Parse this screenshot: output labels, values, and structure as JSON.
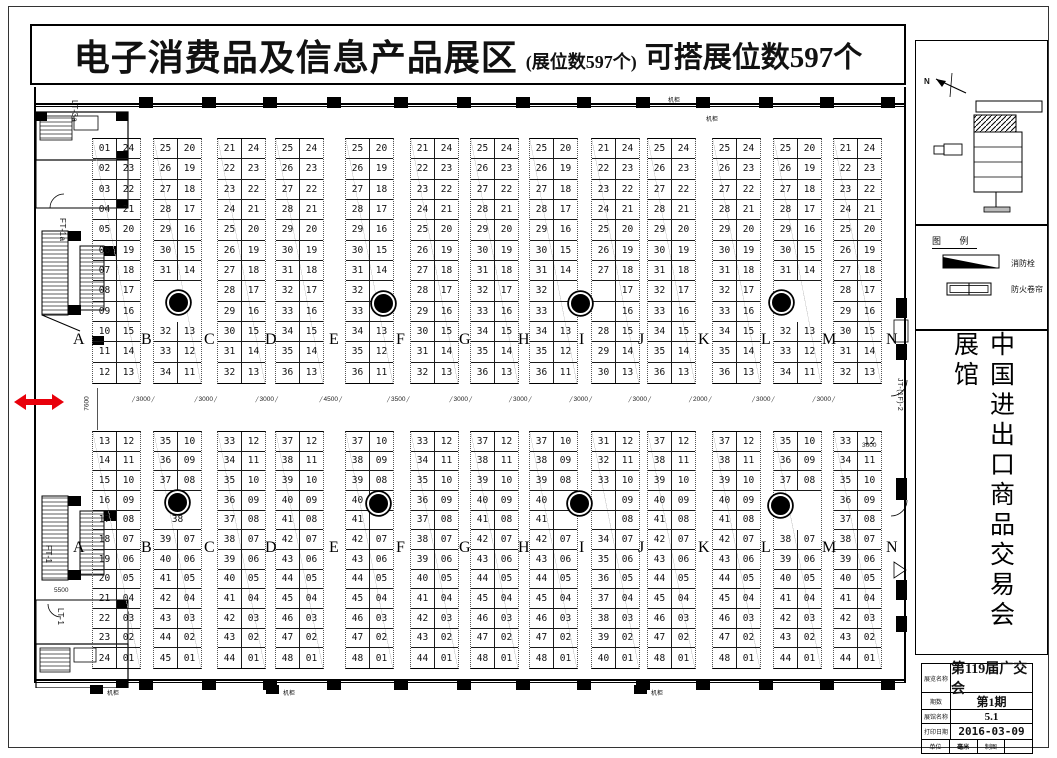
{
  "header": {
    "title": "电子消费品及信息产品展区",
    "booth_count_note": "(展位数597个)",
    "buildable_note": "可搭展位数597个"
  },
  "row_letters": [
    "A",
    "B",
    "C",
    "D",
    "E",
    "F",
    "G",
    "H",
    "I",
    "J",
    "K",
    "L",
    "M",
    "N"
  ],
  "aisle_dims": [
    "3000",
    "3000",
    "3000",
    "4500",
    "3500",
    "3000",
    "3000",
    "3000",
    "3000",
    "2000",
    "3000",
    "3000"
  ],
  "other_dims": {
    "aisle_height": "7600",
    "right_gate": "3600",
    "left_lower": "5500"
  },
  "edge_labels": {
    "lt3a": "LT-3a",
    "ft1a": "FT-1a",
    "ft1": "FT-1",
    "lt1": "LT-1",
    "jt": "JT-(1F)-2"
  },
  "labels": {
    "machine_cabinet": "机柜"
  },
  "compass_label": "N",
  "legend": {
    "title": "图 例",
    "items": [
      {
        "label": "消防栓"
      },
      {
        "label": "防火卷帘"
      }
    ]
  },
  "side_title": "中国进出口商品交易会展馆",
  "title_block": {
    "rows": [
      {
        "label": "展览名称",
        "value": "第119届广交会"
      },
      {
        "label": "期数",
        "value": "第1期"
      },
      {
        "label": "展馆名称",
        "value": "5.1"
      },
      {
        "label": "打印日期",
        "value": "2016-03-09"
      }
    ],
    "last_row": [
      "单位",
      "毫米",
      "制图",
      ""
    ]
  },
  "top_strips": [
    {
      "rows": [
        [
          "01",
          "24"
        ],
        [
          "02",
          "23"
        ],
        [
          "03",
          "22"
        ],
        [
          "04",
          "21"
        ],
        [
          "05",
          "20"
        ],
        [
          "06",
          "19"
        ],
        [
          "07",
          "18"
        ],
        [
          "08",
          "17"
        ],
        [
          "09",
          "16"
        ],
        [
          "10",
          "15"
        ],
        [
          "11",
          "14"
        ],
        [
          "12",
          "13"
        ]
      ]
    },
    {
      "rows": [
        [
          "25",
          "20"
        ],
        [
          "26",
          "19"
        ],
        [
          "27",
          "18"
        ],
        [
          "28",
          "17"
        ],
        [
          "29",
          "16"
        ],
        [
          "30",
          "15"
        ],
        [
          "31",
          "14"
        ],
        [
          "#GAP",
          "2"
        ],
        [
          "32",
          "13"
        ],
        [
          "33",
          "12"
        ],
        [
          "34",
          "11"
        ]
      ]
    },
    {
      "rows": [
        [
          "21",
          "24"
        ],
        [
          "22",
          "23"
        ],
        [
          "23",
          "22"
        ],
        [
          "24",
          "21"
        ],
        [
          "25",
          "20"
        ],
        [
          "26",
          "19"
        ],
        [
          "27",
          "18"
        ],
        [
          "28",
          "17"
        ],
        [
          "29",
          "16"
        ],
        [
          "30",
          "15"
        ],
        [
          "31",
          "14"
        ],
        [
          "32",
          "13"
        ]
      ]
    },
    {
      "rows": [
        [
          "25",
          "24"
        ],
        [
          "26",
          "23"
        ],
        [
          "27",
          "22"
        ],
        [
          "28",
          "21"
        ],
        [
          "29",
          "20"
        ],
        [
          "30",
          "19"
        ],
        [
          "31",
          "18"
        ],
        [
          "32",
          "17"
        ],
        [
          "33",
          "16"
        ],
        [
          "34",
          "15"
        ],
        [
          "35",
          "14"
        ],
        [
          "36",
          "13"
        ]
      ]
    },
    {
      "rows": [
        [
          "25",
          "20"
        ],
        [
          "26",
          "19"
        ],
        [
          "27",
          "18"
        ],
        [
          "28",
          "17"
        ],
        [
          "29",
          "16"
        ],
        [
          "30",
          "15"
        ],
        [
          "31",
          "14"
        ],
        [
          "32",
          ""
        ],
        [
          "33",
          ""
        ],
        [
          "34",
          "13"
        ],
        [
          "35",
          "12"
        ],
        [
          "36",
          "11"
        ]
      ]
    },
    {
      "rows": [
        [
          "21",
          "24"
        ],
        [
          "22",
          "23"
        ],
        [
          "23",
          "22"
        ],
        [
          "24",
          "21"
        ],
        [
          "25",
          "20"
        ],
        [
          "26",
          "19"
        ],
        [
          "27",
          "18"
        ],
        [
          "28",
          "17"
        ],
        [
          "29",
          "16"
        ],
        [
          "30",
          "15"
        ],
        [
          "31",
          "14"
        ],
        [
          "32",
          "13"
        ]
      ]
    },
    {
      "rows": [
        [
          "25",
          "24"
        ],
        [
          "26",
          "23"
        ],
        [
          "27",
          "22"
        ],
        [
          "28",
          "21"
        ],
        [
          "29",
          "20"
        ],
        [
          "30",
          "19"
        ],
        [
          "31",
          "18"
        ],
        [
          "32",
          "17"
        ],
        [
          "33",
          "16"
        ],
        [
          "34",
          "15"
        ],
        [
          "35",
          "14"
        ],
        [
          "36",
          "13"
        ]
      ]
    },
    {
      "rows": [
        [
          "25",
          "20"
        ],
        [
          "26",
          "19"
        ],
        [
          "27",
          "18"
        ],
        [
          "28",
          "17"
        ],
        [
          "29",
          "16"
        ],
        [
          "30",
          "15"
        ],
        [
          "31",
          "14"
        ],
        [
          "32",
          ""
        ],
        [
          "33",
          ""
        ],
        [
          "34",
          "13"
        ],
        [
          "35",
          "12"
        ],
        [
          "36",
          "11"
        ]
      ]
    },
    {
      "rows": [
        [
          "21",
          "24"
        ],
        [
          "22",
          "23"
        ],
        [
          "23",
          "22"
        ],
        [
          "24",
          "21"
        ],
        [
          "25",
          "20"
        ],
        [
          "26",
          "19"
        ],
        [
          "27",
          "18"
        ],
        [
          "",
          "17"
        ],
        [
          "",
          "16"
        ],
        [
          "28",
          "15"
        ],
        [
          "29",
          "14"
        ],
        [
          "30",
          "13"
        ]
      ]
    },
    {
      "rows": [
        [
          "25",
          "24"
        ],
        [
          "26",
          "23"
        ],
        [
          "27",
          "22"
        ],
        [
          "28",
          "21"
        ],
        [
          "29",
          "20"
        ],
        [
          "30",
          "19"
        ],
        [
          "31",
          "18"
        ],
        [
          "32",
          "17"
        ],
        [
          "33",
          "16"
        ],
        [
          "34",
          "15"
        ],
        [
          "35",
          "14"
        ],
        [
          "36",
          "13"
        ]
      ]
    },
    {
      "rows": [
        [
          "25",
          "24"
        ],
        [
          "26",
          "23"
        ],
        [
          "27",
          "22"
        ],
        [
          "28",
          "21"
        ],
        [
          "29",
          "20"
        ],
        [
          "30",
          "19"
        ],
        [
          "31",
          "18"
        ],
        [
          "32",
          "17"
        ],
        [
          "33",
          "16"
        ],
        [
          "34",
          "15"
        ],
        [
          "35",
          "14"
        ],
        [
          "36",
          "13"
        ]
      ]
    },
    {
      "rows": [
        [
          "25",
          "20"
        ],
        [
          "26",
          "19"
        ],
        [
          "27",
          "18"
        ],
        [
          "28",
          "17"
        ],
        [
          "29",
          "16"
        ],
        [
          "30",
          "15"
        ],
        [
          "31",
          "14"
        ],
        [
          "#GAP",
          "2"
        ],
        [
          "32",
          "13"
        ],
        [
          "33",
          "12"
        ],
        [
          "34",
          "11"
        ]
      ]
    },
    {
      "rows": [
        [
          "21",
          "24"
        ],
        [
          "22",
          "23"
        ],
        [
          "23",
          "22"
        ],
        [
          "24",
          "21"
        ],
        [
          "25",
          "20"
        ],
        [
          "26",
          "19"
        ],
        [
          "27",
          "18"
        ],
        [
          "28",
          "17"
        ],
        [
          "29",
          "16"
        ],
        [
          "30",
          "15"
        ],
        [
          "31",
          "14"
        ],
        [
          "32",
          "13"
        ]
      ]
    }
  ],
  "bottom_strips": [
    {
      "rows": [
        [
          "13",
          "12"
        ],
        [
          "14",
          "11"
        ],
        [
          "15",
          "10"
        ],
        [
          "16",
          "09"
        ],
        [
          "17",
          "08"
        ],
        [
          "18",
          "07"
        ],
        [
          "19",
          "06"
        ],
        [
          "20",
          "05"
        ],
        [
          "21",
          "04"
        ],
        [
          "22",
          "03"
        ],
        [
          "23",
          "02"
        ],
        [
          "24",
          "01"
        ]
      ]
    },
    {
      "rows": [
        [
          "35",
          "10"
        ],
        [
          "36",
          "09"
        ],
        [
          "37",
          "08"
        ],
        [
          "#GAP",
          "1"
        ],
        [
          "38"
        ],
        [
          "39",
          "07"
        ],
        [
          "40",
          "06"
        ],
        [
          "41",
          "05"
        ],
        [
          "42",
          "04"
        ],
        [
          "43",
          "03"
        ],
        [
          "44",
          "02"
        ],
        [
          "45",
          "01"
        ]
      ]
    },
    {
      "rows": [
        [
          "33",
          "12"
        ],
        [
          "34",
          "11"
        ],
        [
          "35",
          "10"
        ],
        [
          "36",
          "09"
        ],
        [
          "37",
          "08"
        ],
        [
          "38",
          "07"
        ],
        [
          "39",
          "06"
        ],
        [
          "40",
          "05"
        ],
        [
          "41",
          "04"
        ],
        [
          "42",
          "03"
        ],
        [
          "43",
          "02"
        ],
        [
          "44",
          "01"
        ]
      ]
    },
    {
      "rows": [
        [
          "37",
          "12"
        ],
        [
          "38",
          "11"
        ],
        [
          "39",
          "10"
        ],
        [
          "40",
          "09"
        ],
        [
          "41",
          "08"
        ],
        [
          "42",
          "07"
        ],
        [
          "43",
          "06"
        ],
        [
          "44",
          "05"
        ],
        [
          "45",
          "04"
        ],
        [
          "46",
          "03"
        ],
        [
          "47",
          "02"
        ],
        [
          "48",
          "01"
        ]
      ]
    },
    {
      "rows": [
        [
          "37",
          "10"
        ],
        [
          "38",
          "09"
        ],
        [
          "39",
          "08"
        ],
        [
          "40",
          ""
        ],
        [
          "41",
          ""
        ],
        [
          "42",
          "07"
        ],
        [
          "43",
          "06"
        ],
        [
          "44",
          "05"
        ],
        [
          "45",
          "04"
        ],
        [
          "46",
          "03"
        ],
        [
          "47",
          "02"
        ],
        [
          "48",
          "01"
        ]
      ]
    },
    {
      "rows": [
        [
          "33",
          "12"
        ],
        [
          "34",
          "11"
        ],
        [
          "35",
          "10"
        ],
        [
          "36",
          "09"
        ],
        [
          "37",
          "08"
        ],
        [
          "38",
          "07"
        ],
        [
          "39",
          "06"
        ],
        [
          "40",
          "05"
        ],
        [
          "41",
          "04"
        ],
        [
          "42",
          "03"
        ],
        [
          "43",
          "02"
        ],
        [
          "44",
          "01"
        ]
      ]
    },
    {
      "rows": [
        [
          "37",
          "12"
        ],
        [
          "38",
          "11"
        ],
        [
          "39",
          "10"
        ],
        [
          "40",
          "09"
        ],
        [
          "41",
          "08"
        ],
        [
          "42",
          "07"
        ],
        [
          "43",
          "06"
        ],
        [
          "44",
          "05"
        ],
        [
          "45",
          "04"
        ],
        [
          "46",
          "03"
        ],
        [
          "47",
          "02"
        ],
        [
          "48",
          "01"
        ]
      ]
    },
    {
      "rows": [
        [
          "37",
          "10"
        ],
        [
          "38",
          "09"
        ],
        [
          "39",
          "08"
        ],
        [
          "40",
          ""
        ],
        [
          "41",
          ""
        ],
        [
          "42",
          "07"
        ],
        [
          "43",
          "06"
        ],
        [
          "44",
          "05"
        ],
        [
          "45",
          "04"
        ],
        [
          "46",
          "03"
        ],
        [
          "47",
          "02"
        ],
        [
          "48",
          "01"
        ]
      ]
    },
    {
      "rows": [
        [
          "31",
          "12"
        ],
        [
          "32",
          "11"
        ],
        [
          "33",
          "10"
        ],
        [
          "",
          "09"
        ],
        [
          "",
          "08"
        ],
        [
          "34",
          "07"
        ],
        [
          "35",
          "06"
        ],
        [
          "36",
          "05"
        ],
        [
          "37",
          "04"
        ],
        [
          "38",
          "03"
        ],
        [
          "39",
          "02"
        ],
        [
          "40",
          "01"
        ]
      ]
    },
    {
      "rows": [
        [
          "37",
          "12"
        ],
        [
          "38",
          "11"
        ],
        [
          "39",
          "10"
        ],
        [
          "40",
          "09"
        ],
        [
          "41",
          "08"
        ],
        [
          "42",
          "07"
        ],
        [
          "43",
          "06"
        ],
        [
          "44",
          "05"
        ],
        [
          "45",
          "04"
        ],
        [
          "46",
          "03"
        ],
        [
          "47",
          "02"
        ],
        [
          "48",
          "01"
        ]
      ]
    },
    {
      "rows": [
        [
          "37",
          "12"
        ],
        [
          "38",
          "11"
        ],
        [
          "39",
          "10"
        ],
        [
          "40",
          "09"
        ],
        [
          "41",
          "08"
        ],
        [
          "42",
          "07"
        ],
        [
          "43",
          "06"
        ],
        [
          "44",
          "05"
        ],
        [
          "45",
          "04"
        ],
        [
          "46",
          "03"
        ],
        [
          "47",
          "02"
        ],
        [
          "48",
          "01"
        ]
      ]
    },
    {
      "rows": [
        [
          "35",
          "10"
        ],
        [
          "36",
          "09"
        ],
        [
          "37",
          "08"
        ],
        [
          "#GAP",
          "2"
        ],
        [
          "38",
          "07"
        ],
        [
          "39",
          "06"
        ],
        [
          "40",
          "05"
        ],
        [
          "41",
          "04"
        ],
        [
          "42",
          "03"
        ],
        [
          "43",
          "02"
        ],
        [
          "44",
          "01"
        ]
      ]
    },
    {
      "rows": [
        [
          "33",
          "12"
        ],
        [
          "34",
          "11"
        ],
        [
          "35",
          "10"
        ],
        [
          "36",
          "09"
        ],
        [
          "37",
          "08"
        ],
        [
          "38",
          "07"
        ],
        [
          "39",
          "06"
        ],
        [
          "40",
          "05"
        ],
        [
          "41",
          "04"
        ],
        [
          "42",
          "03"
        ],
        [
          "43",
          "02"
        ],
        [
          "44",
          "01"
        ]
      ]
    }
  ]
}
